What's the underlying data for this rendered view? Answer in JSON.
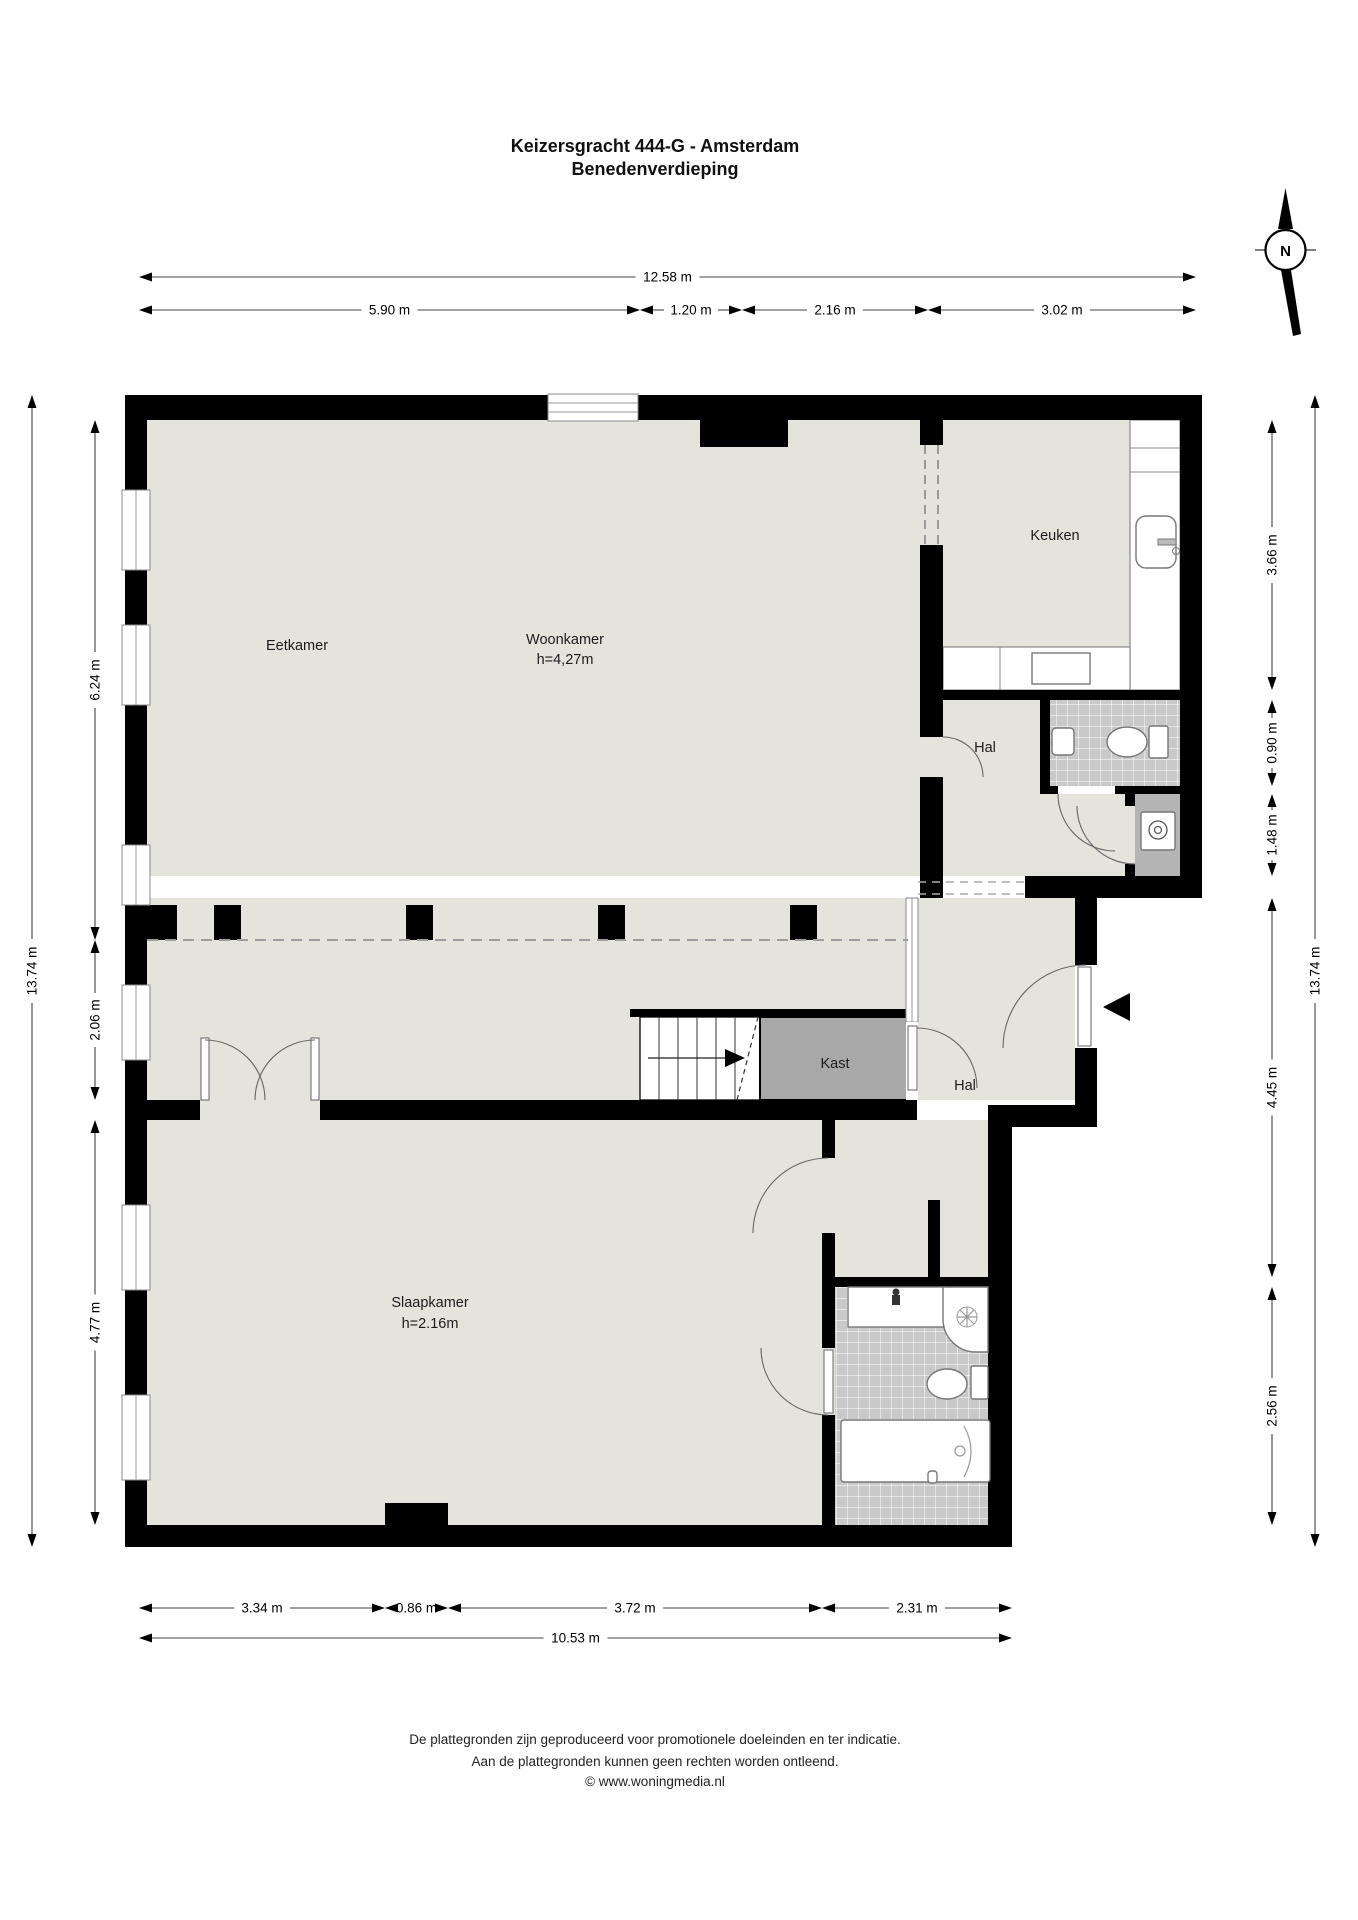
{
  "title": {
    "line1": "Keizersgracht 444-G - Amsterdam",
    "line2": "Benedenverdieping"
  },
  "compass": {
    "label": "N"
  },
  "rooms": {
    "eetkamer": {
      "label": "Eetkamer"
    },
    "woonkamer": {
      "label": "Woonkamer",
      "height": "h=4,27m"
    },
    "keuken": {
      "label": "Keuken"
    },
    "hal_boven": {
      "label": "Hal"
    },
    "kast": {
      "label": "Kast"
    },
    "hal_onder": {
      "label": "Hal"
    },
    "slaapkamer": {
      "label": "Slaapkamer",
      "height": "h=2.16m"
    }
  },
  "dimensions": {
    "top_total": {
      "label": "12.58 m"
    },
    "top_segments": [
      {
        "label": "5.90 m"
      },
      {
        "label": "1.20 m"
      },
      {
        "label": "2.16 m"
      },
      {
        "label": "3.02 m"
      }
    ],
    "left_outer": {
      "label": "13.74 m"
    },
    "left_segments": [
      {
        "label": "6.24 m"
      },
      {
        "label": "2.06 m"
      },
      {
        "label": "4.77 m"
      }
    ],
    "right_outer": {
      "label": "13.74 m"
    },
    "right_segments": [
      {
        "label": "3.66 m"
      },
      {
        "label": "0.90 m"
      },
      {
        "label": "1.48 m"
      },
      {
        "label": "4.45 m"
      },
      {
        "label": "2.56 m"
      }
    ],
    "bottom_segments": [
      {
        "label": "3.34 m"
      },
      {
        "label": "0.86 m"
      },
      {
        "label": "3.72 m"
      },
      {
        "label": "2.31 m"
      }
    ],
    "bottom_total": {
      "label": "10.53 m"
    }
  },
  "footer": {
    "line1": "De plattegronden zijn geproduceerd voor promotionele doeleinden en ter indicatie.",
    "line2": "Aan de plattegronden kunnen geen rechten worden ontleend.",
    "line3": "© www.woningmedia.nl"
  },
  "colors": {
    "floor": "#e4e3dc",
    "wall": "#000000",
    "tile": "#c9c9c9",
    "closet": "#a8a8a8",
    "utility": "#b4b4b4"
  }
}
